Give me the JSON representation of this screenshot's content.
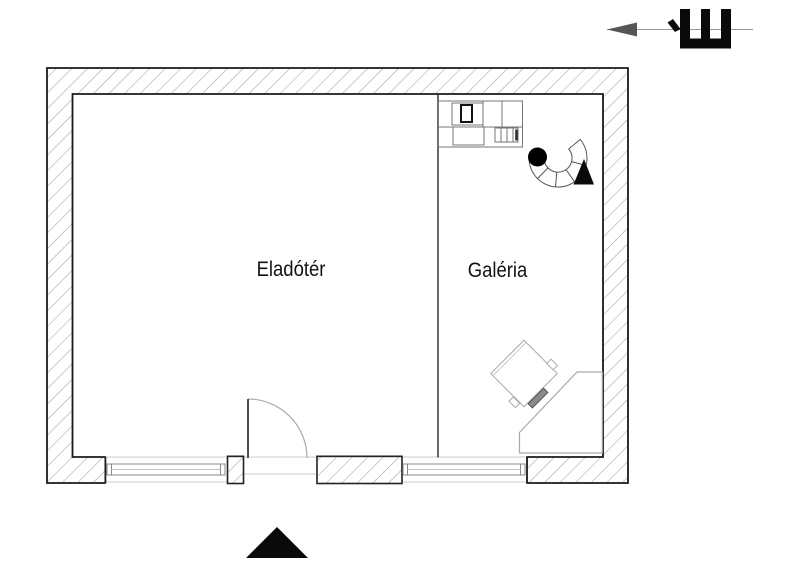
{
  "plan": {
    "type": "architectural-floor-plan",
    "rooms": [
      {
        "name": "Eladótér"
      },
      {
        "name": "Galéria"
      }
    ],
    "north_symbol": {
      "letter": "É",
      "arrow_direction": "left"
    },
    "features": [
      "entrance-door-with-swing",
      "entrance-direction-triangle",
      "two-windows-bottom-wall",
      "spiral-stair",
      "counter-unit",
      "corner-desk",
      "rotated-desk"
    ],
    "colors": {
      "background": "#ffffff",
      "wall_outline": "#1a1a1a",
      "hatch": "#999999",
      "solid_black": "#0a0a0a",
      "furniture_line": "#888888",
      "door_arc": "#aaaaaa",
      "guide_line": "#cccccc"
    }
  }
}
